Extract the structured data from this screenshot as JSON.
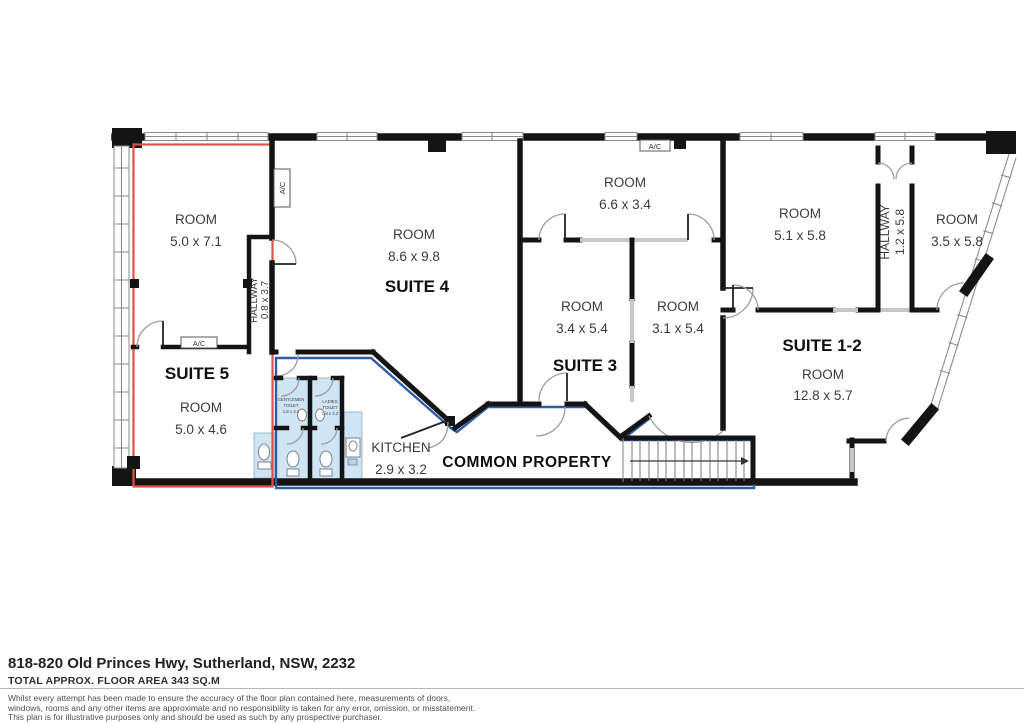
{
  "floorplan": {
    "suite5": {
      "label": "SUITE 5",
      "room1_name": "ROOM",
      "room1_dims": "5.0 x 7.1",
      "room2_name": "ROOM",
      "room2_dims": "5.0 x 4.6",
      "hallway_name": "HALLWAY",
      "hallway_dims": "0.8 x 3.7",
      "ac_label": "A/C"
    },
    "suite4": {
      "label": "SUITE 4",
      "room_name": "ROOM",
      "room_dims": "8.6 x 9.8",
      "ac_label": "A/C"
    },
    "suite3": {
      "label": "SUITE 3",
      "room_top_name": "ROOM",
      "room_top_dims": "6.6 x 3.4",
      "room_left_name": "ROOM",
      "room_left_dims": "3.4 x 5.4",
      "room_right_name": "ROOM",
      "room_right_dims": "3.1 x 5.4",
      "ac_label": "A/C"
    },
    "suite12": {
      "label": "SUITE 1-2",
      "room_tl_name": "ROOM",
      "room_tl_dims": "5.1 x 5.8",
      "room_tr_name": "ROOM",
      "room_tr_dims": "3.5 x 5.8",
      "room_b_name": "ROOM",
      "room_b_dims": "12.8 x 5.7",
      "hallway_name": "HALLWAY",
      "hallway_dims": "1.2 x 5.8"
    },
    "common": {
      "label": "COMMON PROPERTY",
      "kitchen_name": "KITCHEN",
      "kitchen_dims": "2.9 x 3.2",
      "gents_line1": "GENTLEMEN",
      "gents_line2": "TOILET",
      "gents_dims": "1.8 x 3.2",
      "ladies_line1": "LADIES",
      "ladies_line2": "TOILET",
      "ladies_dims": "1.8 x 3.2"
    },
    "colors": {
      "suite5_outline": "#dd5446",
      "common_outline": "#2e5ea8",
      "wet_area_fill": "#cfe5f3",
      "wall": "#141414"
    }
  },
  "footer": {
    "address": "818-820 Old Princes Hwy, Sutherland, NSW, 2232",
    "area": "TOTAL APPROX. FLOOR AREA 343 SQ.M",
    "disclaimer_line1": "Whilst every attempt has been made to ensure the accuracy of the floor plan contained here, measurements of doors,",
    "disclaimer_line2": "windows, rooms and any other items are approximate and no responsibility is taken for any error, omission, or misstatement.",
    "disclaimer_line3": "This plan is for illustrative purposes only and should be used as such by any prospective purchaser."
  }
}
